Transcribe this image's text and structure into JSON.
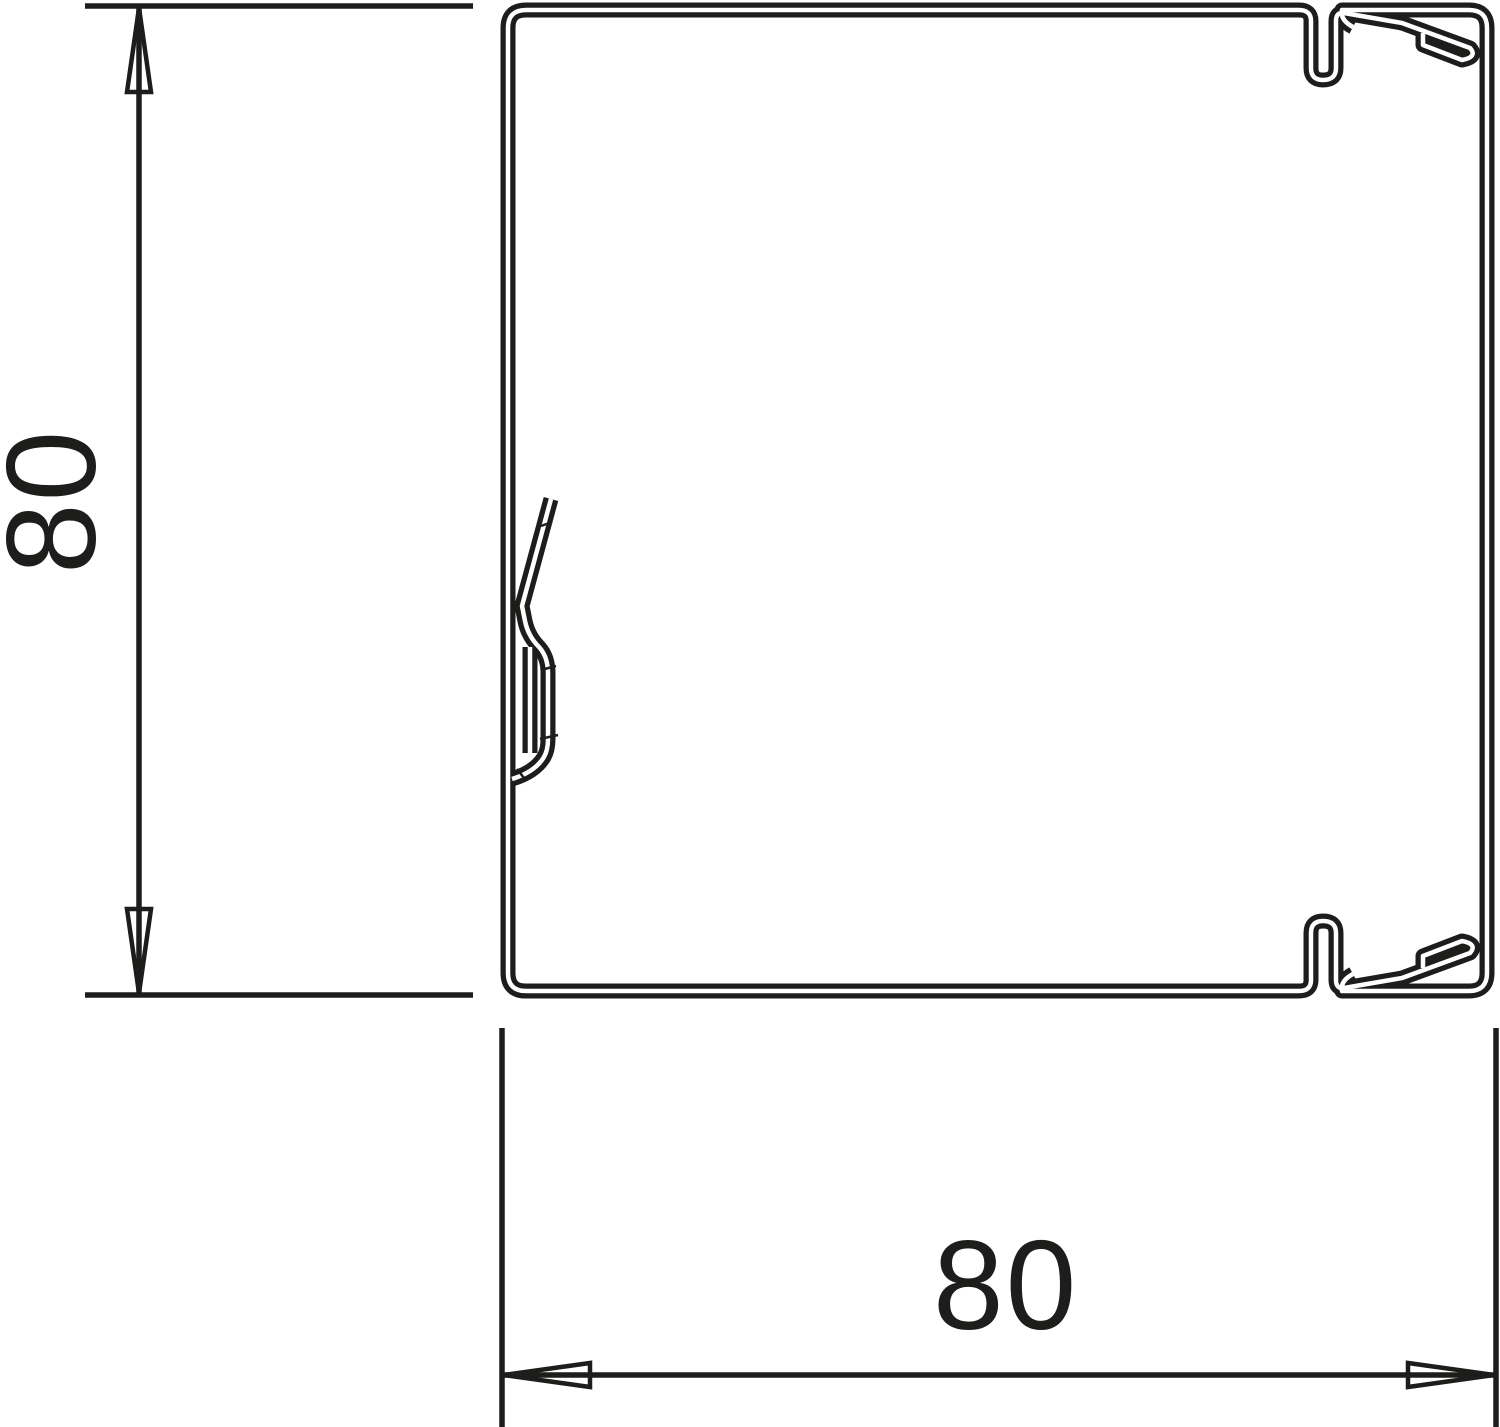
{
  "drawing": {
    "kind": "technical-cross-section",
    "background": "#ffffff",
    "line_color": "#1d1d1b",
    "dimension_height": {
      "label": "80"
    },
    "dimension_width": {
      "label": "80"
    }
  }
}
